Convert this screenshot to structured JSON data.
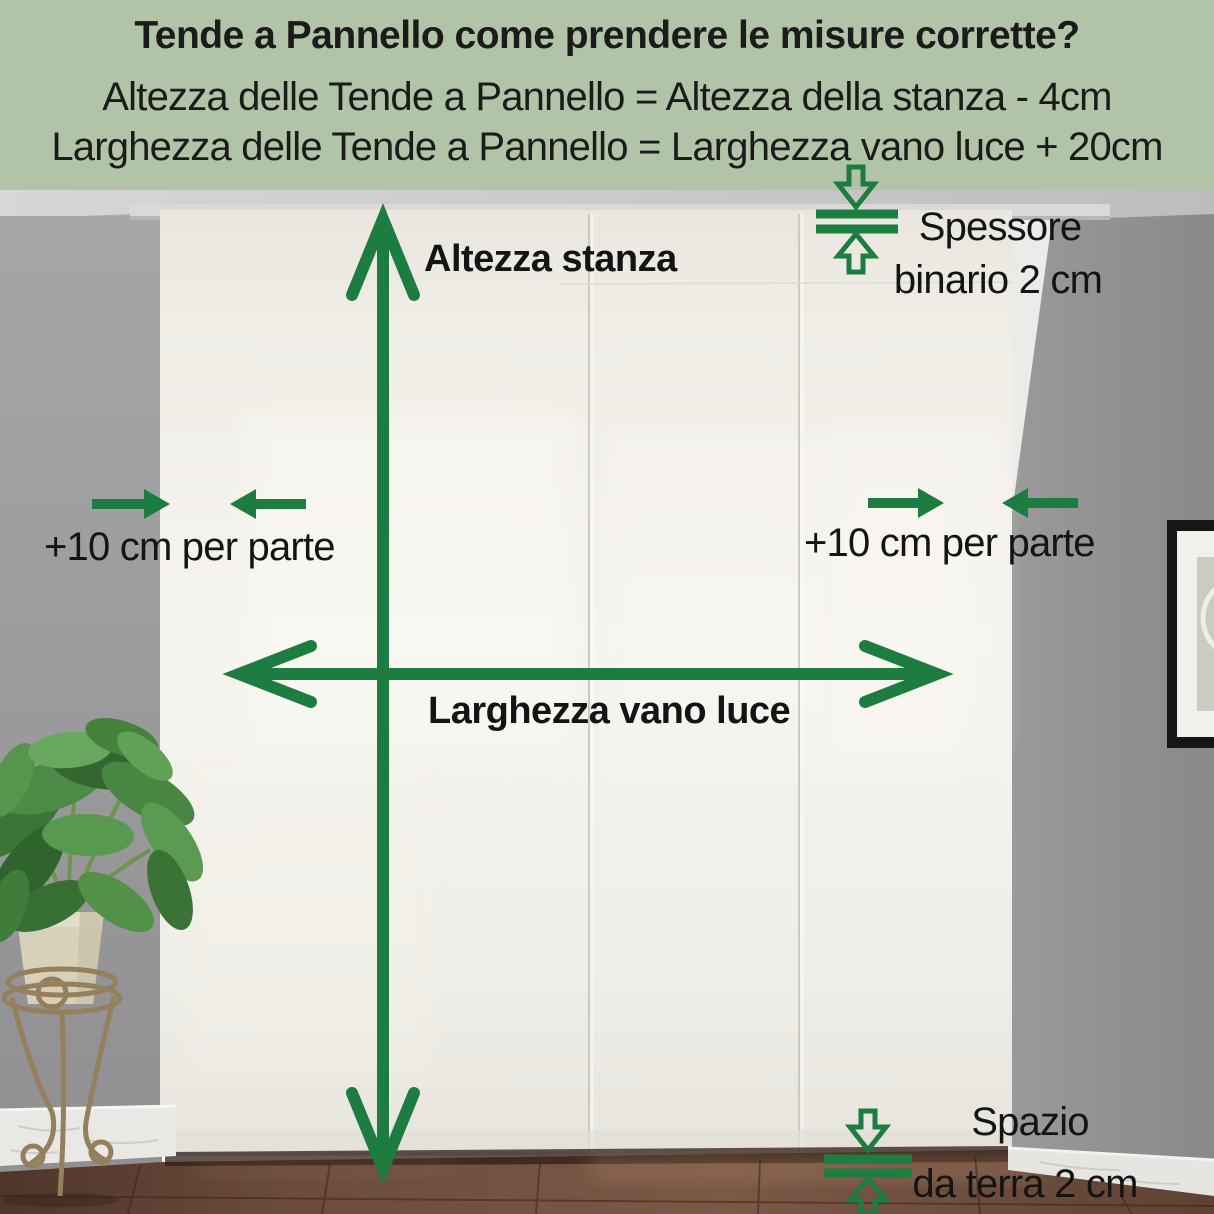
{
  "header": {
    "background": "#b2c4a7",
    "title": "Tende a Pannello come prendere le misure corrette?",
    "formula_height": "Altezza delle Tende a Pannello = Altezza della stanza - 4cm",
    "formula_width": "Larghezza delle Tende a Pannello = Larghezza vano luce + 20cm"
  },
  "annotations": {
    "accent_color": "#1d7c40",
    "room_height_label": "Altezza stanza",
    "track_thickness_label_line1": "Spessore",
    "track_thickness_label_line2": "binario 2 cm",
    "left_side_allowance_label": "+10 cm per parte",
    "right_side_allowance_label": "+10 cm per parte",
    "window_width_label": "Larghezza vano luce",
    "floor_gap_label_line1": "Spazio",
    "floor_gap_label_line2": "da terra 2 cm"
  }
}
